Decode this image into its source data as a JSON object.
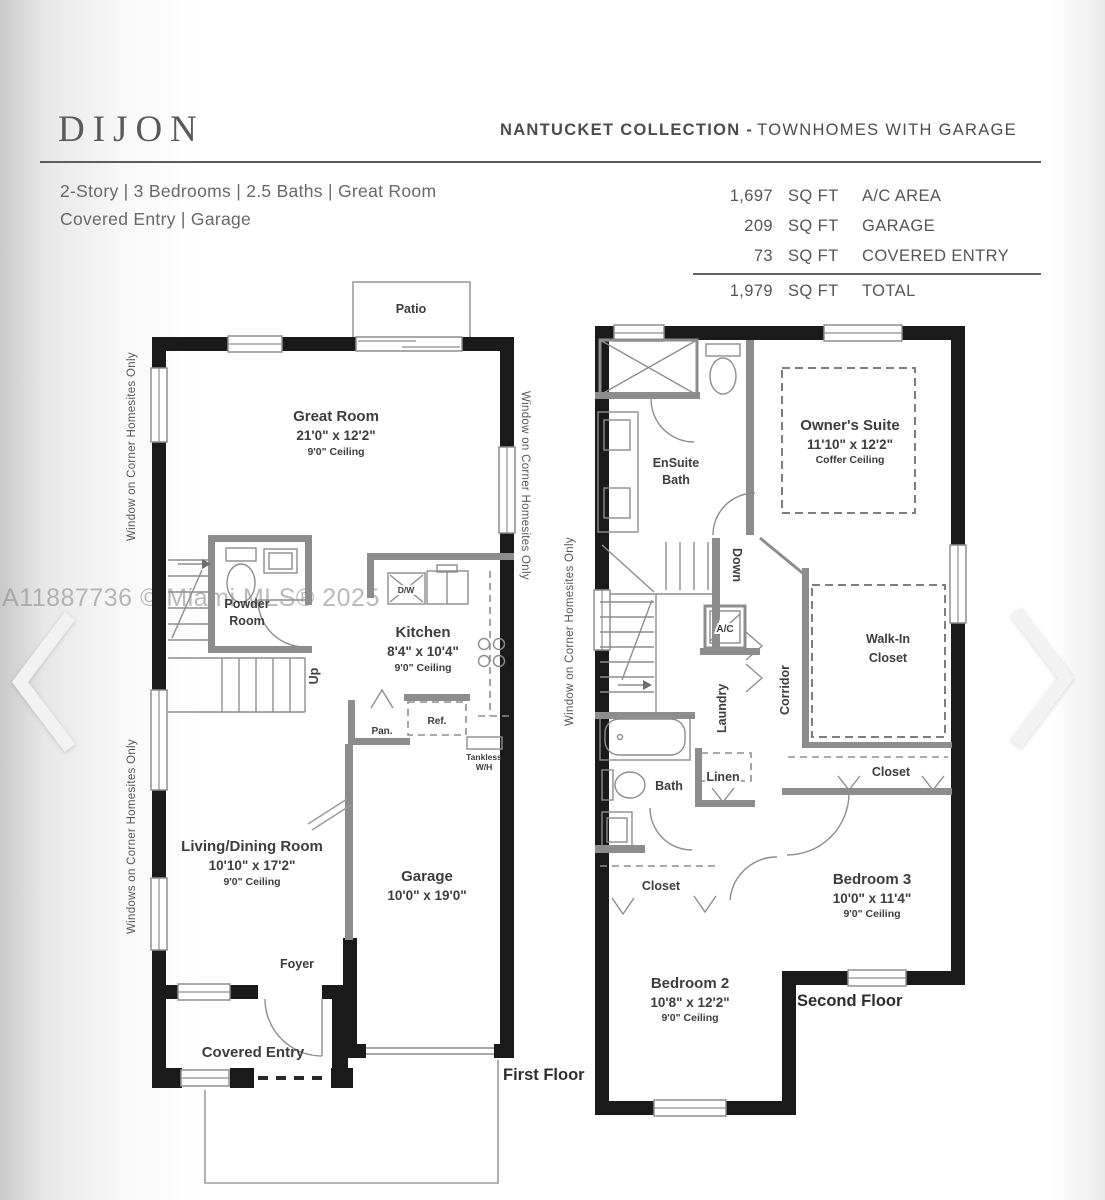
{
  "header": {
    "plan_name": "DIJON",
    "collection_bold": "NANTUCKET COLLECTION -",
    "collection_rest": "TOWNHOMES WITH GARAGE"
  },
  "specs": {
    "line1": "2-Story | 3 Bedrooms | 2.5 Baths | Great Room",
    "line2": "Covered Entry | Garage"
  },
  "areas": {
    "rows": [
      {
        "value": "1,697",
        "unit": "SQ FT",
        "label": "A/C AREA"
      },
      {
        "value": "209",
        "unit": "SQ FT",
        "label": "GARAGE"
      },
      {
        "value": "73",
        "unit": "SQ FT",
        "label": "COVERED ENTRY"
      }
    ],
    "total": {
      "value": "1,979",
      "unit": "SQ FT",
      "label": "TOTAL"
    }
  },
  "watermark": "A11887736 © Miami MLS® 2025",
  "notes": {
    "first_left_top": "Window on Corner Homesites Only",
    "first_left_bottom": "Windows on Corner Homesites Only",
    "first_right": "Window on Corner Homesites Only",
    "second_left": "Window on Corner Homesites Only"
  },
  "first_floor": {
    "caption": "First Floor",
    "patio": "Patio",
    "great_room": {
      "name": "Great Room",
      "dims": "21'0\" x 12'2\"",
      "ceiling": "9'0\" Ceiling"
    },
    "powder_room_line1": "Powder",
    "powder_room_line2": "Room",
    "up": "Up",
    "kitchen": {
      "name": "Kitchen",
      "dims": "8'4\" x 10'4\"",
      "ceiling": "9'0\" Ceiling"
    },
    "dw": "D/W",
    "pan": "Pan.",
    "ref": "Ref.",
    "tankless_line1": "Tankless",
    "tankless_line2": "W/H",
    "living_dining": {
      "name": "Living/Dining Room",
      "dims": "10'10\" x 17'2\"",
      "ceiling": "9'0\" Ceiling"
    },
    "garage": {
      "name": "Garage",
      "dims": "10'0\" x 19'0\""
    },
    "foyer": "Foyer",
    "covered_entry": "Covered Entry"
  },
  "second_floor": {
    "caption": "Second Floor",
    "ensuite_line1": "EnSuite",
    "ensuite_line2": "Bath",
    "owners_suite": {
      "name": "Owner's Suite",
      "dims": "11'10\" x 12'2\"",
      "ceiling": "Coffer Ceiling"
    },
    "down": "Down",
    "ac": "A/C",
    "laundry": "Laundry",
    "corridor": "Corridor",
    "walk_in_line1": "Walk-In",
    "walk_in_line2": "Closet",
    "closet_hall": "Closet",
    "bath": "Bath",
    "linen": "Linen",
    "closet_bed2": "Closet",
    "bedroom3": {
      "name": "Bedroom 3",
      "dims": "10'0\" x 11'4\"",
      "ceiling": "9'0\" Ceiling"
    },
    "bedroom2": {
      "name": "Bedroom 2",
      "dims": "10'8\" x 12'2\"",
      "ceiling": "9'0\" Ceiling"
    }
  },
  "colors": {
    "exterior_wall": "#1a1a1a",
    "interior_wall": "#8d8d8d",
    "label_text": "#3d3d3d",
    "rule_line": "#5b5b5d"
  }
}
